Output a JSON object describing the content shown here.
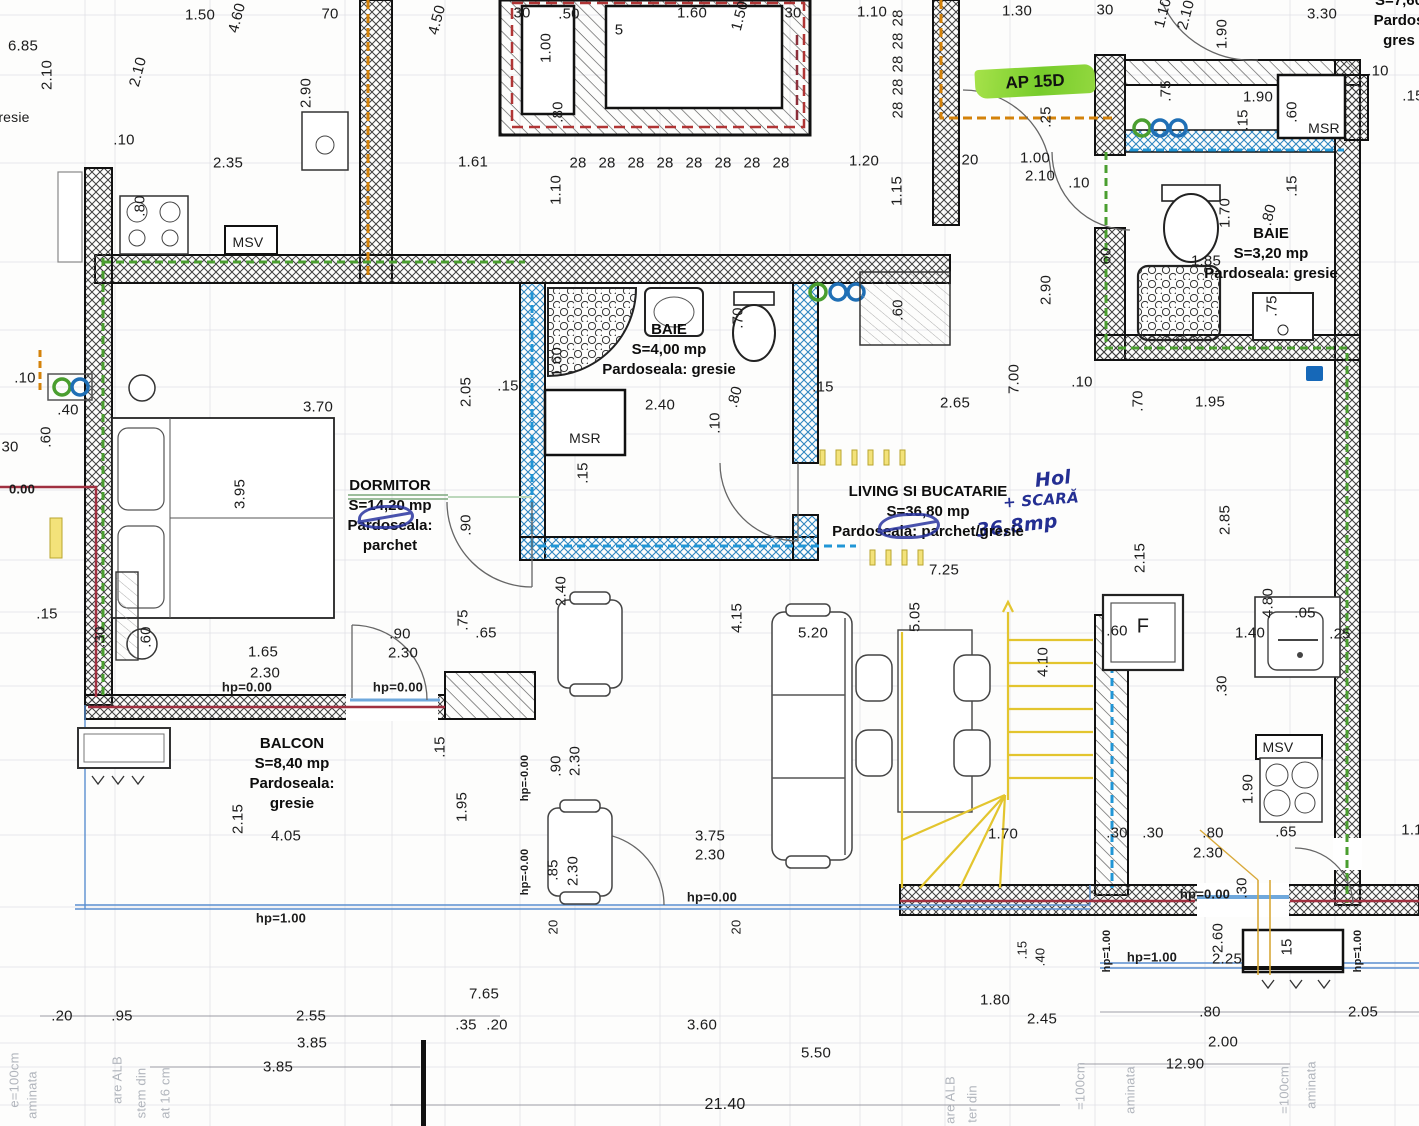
{
  "plan": {
    "apartment": {
      "text": "AP 15D",
      "highlight_color": "#7ec832"
    },
    "colors": {
      "ink_blue": "#242f93",
      "pipe_orange": "#d4820a",
      "pipe_green": "#4a9e2f",
      "pipe_blue": "#2196d6",
      "pipe_red": "#a03040",
      "stair_yellow": "#e3c52e",
      "red_dashed": "#b03535"
    },
    "rooms": [
      {
        "id": "dormitor",
        "x": 390,
        "y": 486,
        "lines": [
          "DORMITOR",
          "S=14,20 mp",
          "Pardoseala:",
          "parchet"
        ]
      },
      {
        "id": "baie-centru",
        "x": 669,
        "y": 330,
        "lines": [
          "BAIE",
          "S=4,00 mp",
          "Pardoseala: gresie"
        ]
      },
      {
        "id": "living-bucatarie",
        "x": 928,
        "y": 492,
        "lines": [
          "LIVING SI BUCATARIE",
          "S=36,80 mp",
          "Pardoseala: parchet/gresie"
        ]
      },
      {
        "id": "balcon",
        "x": 292,
        "y": 744,
        "lines": [
          "BALCON",
          "S=8,40 mp",
          "Pardoseala:",
          "gresie"
        ]
      },
      {
        "id": "baie-dreapta",
        "x": 1271,
        "y": 234,
        "lines": [
          "BAIE",
          "S=3,20 mp",
          "Pardoseala: gresie"
        ]
      },
      {
        "id": "vecin-partial",
        "x": 1399,
        "y": 1,
        "lines": [
          "S=7,60",
          "Pardos",
          "gres"
        ]
      }
    ],
    "handwritten": [
      {
        "t": "Hol",
        "x": 1053,
        "y": 479,
        "s": 19,
        "r": -6
      },
      {
        "t": "+ SCARĂ",
        "x": 1041,
        "y": 500,
        "s": 15,
        "r": -4
      },
      {
        "t": "36,8mp",
        "x": 1017,
        "y": 526,
        "s": 19,
        "r": -7
      }
    ],
    "faint": [
      {
        "t": "e=100cm",
        "x": 14,
        "y": 1080,
        "r": -90
      },
      {
        "t": "aminata",
        "x": 32,
        "y": 1095,
        "r": -90
      },
      {
        "t": "are ALB",
        "x": 117,
        "y": 1080,
        "r": -90
      },
      {
        "t": "stem din",
        "x": 141,
        "y": 1093,
        "r": -90
      },
      {
        "t": "at 16 cm",
        "x": 165,
        "y": 1093,
        "r": -90
      },
      {
        "t": "are ALB",
        "x": 950,
        "y": 1100,
        "r": -90
      },
      {
        "t": "ter din",
        "x": 972,
        "y": 1104,
        "r": -90
      },
      {
        "t": "=100cm",
        "x": 1080,
        "y": 1086,
        "r": -90
      },
      {
        "t": "aminata",
        "x": 1130,
        "y": 1090,
        "r": -90
      },
      {
        "t": "=100cm",
        "x": 1284,
        "y": 1090,
        "r": -90
      },
      {
        "t": "aminata",
        "x": 1311,
        "y": 1085,
        "r": -90
      }
    ],
    "labels": [
      {
        "t": "1.50",
        "x": 200,
        "y": 15
      },
      {
        "t": "4.60",
        "x": 237,
        "y": 18,
        "r": -75
      },
      {
        "t": "70",
        "x": 330,
        "y": 14
      },
      {
        "t": "6.85",
        "x": 23,
        "y": 46
      },
      {
        "t": "2.10",
        "x": 47,
        "y": 75,
        "r": -90
      },
      {
        "t": "2.10",
        "x": 138,
        "y": 72,
        "r": -75
      },
      {
        "t": "gresie",
        "x": 10,
        "y": 117,
        "s": 14
      },
      {
        "t": ".10",
        "x": 124,
        "y": 140
      },
      {
        "t": "2.35",
        "x": 228,
        "y": 163
      },
      {
        "t": "2.90",
        "x": 306,
        "y": 93,
        "r": -90
      },
      {
        "t": ".80",
        "x": 140,
        "y": 206,
        "r": -90
      },
      {
        "t": "MSV",
        "x": 248,
        "y": 242,
        "s": 14
      },
      {
        "t": "4.50",
        "x": 437,
        "y": 20,
        "r": -75
      },
      {
        "t": "30",
        "x": 522,
        "y": 13
      },
      {
        "t": ".50",
        "x": 569,
        "y": 14
      },
      {
        "t": "1.00",
        "x": 546,
        "y": 48,
        "r": -90
      },
      {
        "t": "5",
        "x": 619,
        "y": 30
      },
      {
        "t": "1.60",
        "x": 692,
        "y": 13
      },
      {
        "t": "1.50",
        "x": 740,
        "y": 16,
        "r": -75
      },
      {
        "t": "30",
        "x": 793,
        "y": 13
      },
      {
        "t": ".80",
        "x": 558,
        "y": 112,
        "r": -90
      },
      {
        "t": "1.61",
        "x": 473,
        "y": 162
      },
      {
        "t": "1.10",
        "x": 556,
        "y": 190,
        "r": -90
      },
      {
        "t": "28",
        "x": 578,
        "y": 163
      },
      {
        "t": "28",
        "x": 607,
        "y": 163
      },
      {
        "t": "28",
        "x": 636,
        "y": 163
      },
      {
        "t": "28",
        "x": 665,
        "y": 163
      },
      {
        "t": "28",
        "x": 694,
        "y": 163
      },
      {
        "t": "28",
        "x": 723,
        "y": 163
      },
      {
        "t": "28",
        "x": 752,
        "y": 163
      },
      {
        "t": "28",
        "x": 781,
        "y": 163
      },
      {
        "t": "1.10",
        "x": 872,
        "y": 12
      },
      {
        "t": "28",
        "x": 898,
        "y": 18,
        "r": -90
      },
      {
        "t": "28",
        "x": 898,
        "y": 41,
        "r": -90
      },
      {
        "t": "28",
        "x": 898,
        "y": 64,
        "r": -90
      },
      {
        "t": "28",
        "x": 898,
        "y": 87,
        "r": -90
      },
      {
        "t": "28",
        "x": 898,
        "y": 110,
        "r": -90
      },
      {
        "t": "1.30",
        "x": 1017,
        "y": 11
      },
      {
        "t": "30",
        "x": 1105,
        "y": 10
      },
      {
        "t": "1.10",
        "x": 1163,
        "y": 13,
        "r": -75
      },
      {
        "t": "2.10",
        "x": 1186,
        "y": 15,
        "r": -75
      },
      {
        "t": "3.30",
        "x": 1322,
        "y": 14
      },
      {
        "t": "1.90",
        "x": 1222,
        "y": 34,
        "r": -90
      },
      {
        "t": "1.20",
        "x": 864,
        "y": 161
      },
      {
        "t": "20",
        "x": 970,
        "y": 160
      },
      {
        "t": "1.00",
        "x": 1035,
        "y": 158
      },
      {
        "t": "2.10",
        "x": 1040,
        "y": 176
      },
      {
        "t": ".10",
        "x": 1079,
        "y": 183
      },
      {
        "t": "1.15",
        "x": 897,
        "y": 191,
        "r": -90
      },
      {
        "t": ".25",
        "x": 1046,
        "y": 117,
        "r": -90
      },
      {
        "t": ".75",
        "x": 1166,
        "y": 91,
        "r": -90
      },
      {
        "t": "1.90",
        "x": 1258,
        "y": 97
      },
      {
        "t": ".15",
        "x": 1243,
        "y": 120,
        "r": -90
      },
      {
        "t": ".60",
        "x": 1292,
        "y": 112,
        "r": -90
      },
      {
        "t": "MSR",
        "x": 1324,
        "y": 128,
        "s": 14
      },
      {
        "t": ".10",
        "x": 1378,
        "y": 71
      },
      {
        "t": ".15",
        "x": 1413,
        "y": 96
      },
      {
        "t": ".15",
        "x": 1292,
        "y": 186,
        "r": -90
      },
      {
        "t": "1.70",
        "x": 1225,
        "y": 213,
        "r": -90
      },
      {
        "t": ".80",
        "x": 1269,
        "y": 215,
        "r": -75
      },
      {
        "t": "1.85",
        "x": 1206,
        "y": 261
      },
      {
        "t": ".75",
        "x": 1272,
        "y": 306,
        "r": -90
      },
      {
        "t": ".60",
        "x": 1106,
        "y": 258,
        "r": -90
      },
      {
        "t": "2.40",
        "x": 660,
        "y": 405
      },
      {
        "t": "MSR",
        "x": 585,
        "y": 438,
        "s": 14
      },
      {
        "t": "1.60",
        "x": 557,
        "y": 362,
        "r": -90
      },
      {
        "t": ".70",
        "x": 738,
        "y": 318,
        "r": -90
      },
      {
        "t": ".80",
        "x": 735,
        "y": 397,
        "r": -75
      },
      {
        "t": ".10",
        "x": 715,
        "y": 423,
        "r": -90
      },
      {
        "t": ".15",
        "x": 823,
        "y": 387
      },
      {
        "t": "2.05",
        "x": 466,
        "y": 392,
        "r": -90
      },
      {
        "t": ".15",
        "x": 508,
        "y": 386
      },
      {
        "t": "3.70",
        "x": 318,
        "y": 407
      },
      {
        "t": "3.95",
        "x": 240,
        "y": 494,
        "r": -90
      },
      {
        "t": "2.65",
        "x": 955,
        "y": 403
      },
      {
        "t": "7.00",
        "x": 1014,
        "y": 379,
        "r": -90
      },
      {
        "t": "2.90",
        "x": 1046,
        "y": 290,
        "r": -90
      },
      {
        "t": ".60",
        "x": 898,
        "y": 310,
        "r": -90
      },
      {
        "t": ".10",
        "x": 1082,
        "y": 382
      },
      {
        "t": ".70",
        "x": 1138,
        "y": 401,
        "r": -90
      },
      {
        "t": "1.95",
        "x": 1210,
        "y": 402
      },
      {
        "t": "2.85",
        "x": 1225,
        "y": 520,
        "r": -90
      },
      {
        "t": "2.15",
        "x": 1140,
        "y": 558,
        "r": -90
      },
      {
        "t": ".90",
        "x": 466,
        "y": 525,
        "r": -90
      },
      {
        "t": ".15",
        "x": 583,
        "y": 473,
        "r": -90
      },
      {
        "t": "2.40",
        "x": 561,
        "y": 591,
        "r": -90
      },
      {
        "t": ".75",
        "x": 463,
        "y": 620,
        "r": -90
      },
      {
        "t": ".65",
        "x": 486,
        "y": 633
      },
      {
        "t": ".90",
        "x": 400,
        "y": 634
      },
      {
        "t": "2.30",
        "x": 403,
        "y": 653
      },
      {
        "t": "1.65",
        "x": 263,
        "y": 652
      },
      {
        "t": "2.30",
        "x": 265,
        "y": 673
      },
      {
        "t": "hp=0.00",
        "x": 247,
        "y": 687,
        "w": 1,
        "s": 13
      },
      {
        "t": "hp=0.00",
        "x": 398,
        "y": 687,
        "w": 1,
        "s": 13
      },
      {
        "t": ".15",
        "x": 47,
        "y": 614
      },
      {
        "t": ".30",
        "x": 100,
        "y": 637,
        "r": -90
      },
      {
        "t": ".60",
        "x": 146,
        "y": 637,
        "r": -90
      },
      {
        "t": ".10",
        "x": 25,
        "y": 378
      },
      {
        "t": ".40",
        "x": 68,
        "y": 410
      },
      {
        "t": ".60",
        "x": 46,
        "y": 437,
        "r": -90
      },
      {
        "t": "30",
        "x": 10,
        "y": 447
      },
      {
        "t": "0.00",
        "x": 22,
        "y": 489,
        "w": 1,
        "s": 13
      },
      {
        "t": "7.25",
        "x": 944,
        "y": 570
      },
      {
        "t": "4.15",
        "x": 737,
        "y": 618,
        "r": -90
      },
      {
        "t": "5.20",
        "x": 813,
        "y": 633
      },
      {
        "t": "5.05",
        "x": 915,
        "y": 617,
        "r": -90
      },
      {
        "t": "4.10",
        "x": 1043,
        "y": 662,
        "r": -90
      },
      {
        "t": "1.70",
        "x": 1003,
        "y": 834
      },
      {
        "t": ".30",
        "x": 1117,
        "y": 833
      },
      {
        "t": ".30",
        "x": 1153,
        "y": 833
      },
      {
        "t": ".80",
        "x": 1213,
        "y": 833
      },
      {
        "t": "2.30",
        "x": 1208,
        "y": 853
      },
      {
        "t": "3.75",
        "x": 710,
        "y": 836
      },
      {
        "t": "2.30",
        "x": 710,
        "y": 855
      },
      {
        "t": "hp=0.00",
        "x": 712,
        "y": 897,
        "w": 1,
        "s": 13
      },
      {
        "t": ".60",
        "x": 1117,
        "y": 631
      },
      {
        "t": "F",
        "x": 1143,
        "y": 627,
        "s": 20
      },
      {
        "t": "4.80",
        "x": 1268,
        "y": 603,
        "r": -90
      },
      {
        "t": ".05",
        "x": 1305,
        "y": 613
      },
      {
        "t": "1.40",
        "x": 1250,
        "y": 633
      },
      {
        "t": ".25",
        "x": 1340,
        "y": 634
      },
      {
        "t": ".30",
        "x": 1222,
        "y": 686,
        "r": -90
      },
      {
        "t": "MSV",
        "x": 1278,
        "y": 747,
        "s": 14
      },
      {
        "t": "1.90",
        "x": 1248,
        "y": 789,
        "r": -90
      },
      {
        "t": ".65",
        "x": 1286,
        "y": 832
      },
      {
        "t": "1.1",
        "x": 1412,
        "y": 830
      },
      {
        "t": ".30",
        "x": 1242,
        "y": 888,
        "r": -90
      },
      {
        "t": "2.30",
        "x": 575,
        "y": 761,
        "r": -90
      },
      {
        "t": ".90",
        "x": 556,
        "y": 766,
        "r": -90
      },
      {
        "t": ".85",
        "x": 553,
        "y": 870,
        "r": -90
      },
      {
        "t": "2.30",
        "x": 573,
        "y": 871,
        "r": -90
      },
      {
        "t": "hp=-0.00",
        "x": 525,
        "y": 778,
        "r": -90,
        "w": 1,
        "s": 11
      },
      {
        "t": "hp=-0.00",
        "x": 525,
        "y": 872,
        "r": -90,
        "w": 1,
        "s": 11
      },
      {
        "t": "20",
        "x": 553,
        "y": 927,
        "r": -90,
        "s": 13
      },
      {
        "t": "20",
        "x": 736,
        "y": 927,
        "r": -90,
        "s": 13
      },
      {
        "t": "4.05",
        "x": 286,
        "y": 836
      },
      {
        "t": "2.15",
        "x": 238,
        "y": 819,
        "r": -90
      },
      {
        "t": ".15",
        "x": 440,
        "y": 747,
        "r": -90
      },
      {
        "t": "1.95",
        "x": 462,
        "y": 807,
        "r": -90
      },
      {
        "t": "hp=1.00",
        "x": 281,
        "y": 918,
        "w": 1,
        "s": 13
      },
      {
        "t": ".20",
        "x": 62,
        "y": 1016
      },
      {
        "t": ".95",
        "x": 122,
        "y": 1016
      },
      {
        "t": "2.55",
        "x": 311,
        "y": 1016
      },
      {
        "t": "3.85",
        "x": 312,
        "y": 1043
      },
      {
        "t": "3.85",
        "x": 278,
        "y": 1067
      },
      {
        "t": "7.65",
        "x": 484,
        "y": 994
      },
      {
        "t": ".35",
        "x": 466,
        "y": 1025
      },
      {
        "t": ".20",
        "x": 497,
        "y": 1025
      },
      {
        "t": "3.60",
        "x": 702,
        "y": 1025
      },
      {
        "t": "5.50",
        "x": 816,
        "y": 1053
      },
      {
        "t": "21.40",
        "x": 725,
        "y": 1105,
        "s": 16
      },
      {
        "t": "1.80",
        "x": 995,
        "y": 1000
      },
      {
        "t": "2.45",
        "x": 1042,
        "y": 1019
      },
      {
        "t": ".15",
        "x": 1022,
        "y": 950,
        "r": -90,
        "s": 13
      },
      {
        "t": ".40",
        "x": 1040,
        "y": 957,
        "r": -90,
        "s": 13
      },
      {
        "t": "hp=0.00",
        "x": 1205,
        "y": 894,
        "w": 1,
        "s": 13
      },
      {
        "t": "hp=1.00",
        "x": 1152,
        "y": 957,
        "w": 1,
        "s": 13
      },
      {
        "t": "2.60",
        "x": 1218,
        "y": 938,
        "r": -90
      },
      {
        "t": "2.25",
        "x": 1227,
        "y": 959
      },
      {
        "t": "15",
        "x": 1287,
        "y": 947,
        "r": -90
      },
      {
        "t": "hp=1.00",
        "x": 1107,
        "y": 951,
        "r": -90,
        "w": 1,
        "s": 11
      },
      {
        "t": "hp=1.00",
        "x": 1358,
        "y": 951,
        "r": -90,
        "w": 1,
        "s": 11
      },
      {
        "t": ".80",
        "x": 1210,
        "y": 1012
      },
      {
        "t": "2.05",
        "x": 1363,
        "y": 1012
      },
      {
        "t": "2.00",
        "x": 1223,
        "y": 1042
      },
      {
        "t": "12.90",
        "x": 1185,
        "y": 1064
      }
    ]
  }
}
